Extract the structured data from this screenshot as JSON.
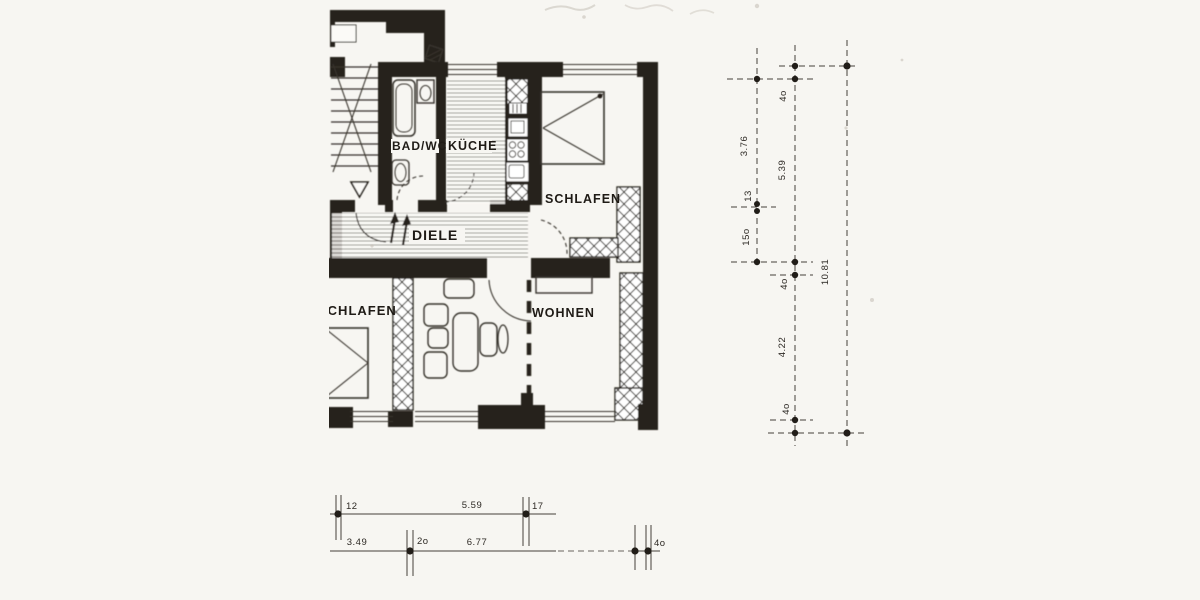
{
  "drawing": {
    "kind": "scanned apartment floor plan",
    "colors": {
      "paper": "#f7f6f2",
      "ink": "#25211c"
    }
  },
  "rooms": {
    "bad_wc": {
      "label": "BAD/WC"
    },
    "kueche": {
      "label": "KÜCHE"
    },
    "schlafen_top": {
      "label": "SCHLAFEN"
    },
    "diele": {
      "label": "DIELE"
    },
    "schlafen_left": {
      "label": "SCHLAFEN"
    },
    "wohnen": {
      "label": "WOHNEN"
    }
  },
  "dims": {
    "right": {
      "col1": [
        "3.76",
        "13",
        "15o"
      ],
      "col2": [
        "4o",
        "5.39",
        "4o",
        "4.22",
        "4o"
      ],
      "total": "10.81"
    },
    "bottom": {
      "upper": [
        "12",
        "5.59",
        "17"
      ],
      "lower": [
        "3.49",
        "2o",
        "6.77",
        "4o"
      ]
    }
  }
}
